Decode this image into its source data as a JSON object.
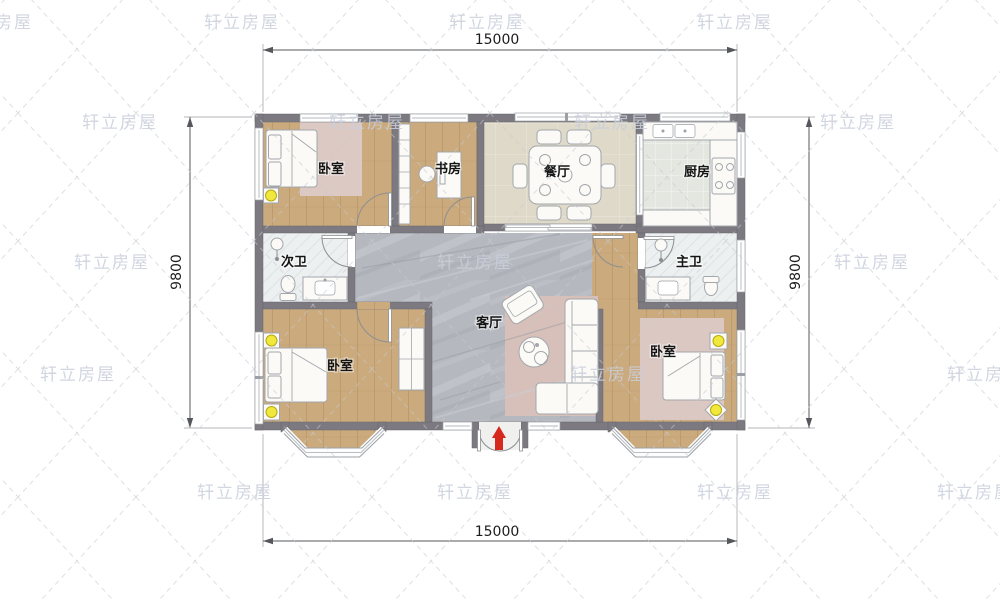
{
  "watermark": {
    "text": "轩立房屋",
    "color": "#c9cfdc"
  },
  "dimensions": {
    "top": "15000",
    "bottom": "15000",
    "left": "9800",
    "right": "9800"
  },
  "rooms": {
    "bedroom_top_left": "卧室",
    "study": "书房",
    "dining": "餐厅",
    "kitchen": "厨房",
    "bath_secondary": "次卫",
    "bath_master": "主卫",
    "living": "客厅",
    "bedroom_bottom_left": "卧室",
    "bedroom_bottom_right": "卧室"
  },
  "colors": {
    "wall": "#7c7a80",
    "wood_floor": "#cbaa7d",
    "marble_floor": "#b5b9bf",
    "dining_floor": "#ded9c8",
    "kitchen_floor": "#e3e7e0",
    "bath_floor": "#edf0f0",
    "rug_pink": "#d8c3bd",
    "lamp_yellow": "#f0e83c",
    "entry_marker_red": "#d7281d",
    "dimension_text": "#1c1c1c",
    "watermark": "#c9cfdc"
  }
}
